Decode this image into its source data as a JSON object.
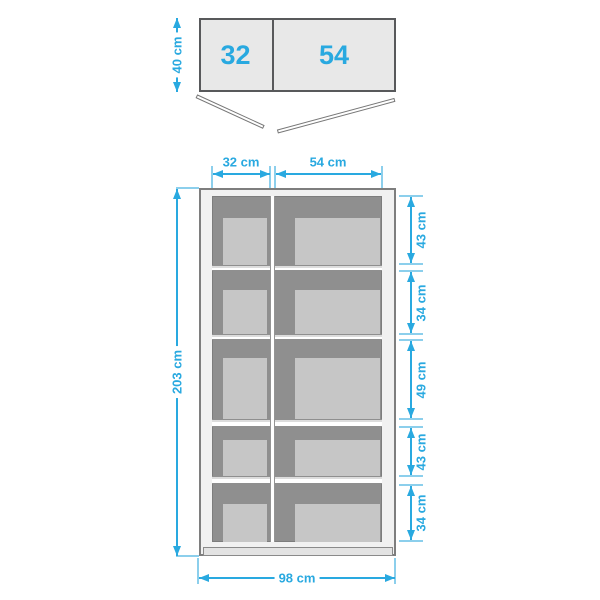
{
  "top_view": {
    "left_door_width": "32",
    "right_door_width": "54",
    "depth": "40 cm"
  },
  "front_view": {
    "left_section_width": "32 cm",
    "right_section_width": "54 cm",
    "total_height": "203 cm",
    "total_width": "98 cm",
    "shelf_sections": [
      "43 cm",
      "34 cm",
      "49 cm",
      "43 cm",
      "34 cm"
    ]
  },
  "colors": {
    "blue": "#29a9e0",
    "ext_blue": "#8ccfec",
    "interior": "#8f8f8f",
    "panel": "#c6c6c6",
    "frame": "#f1f1f1",
    "outline": "#58595b"
  }
}
